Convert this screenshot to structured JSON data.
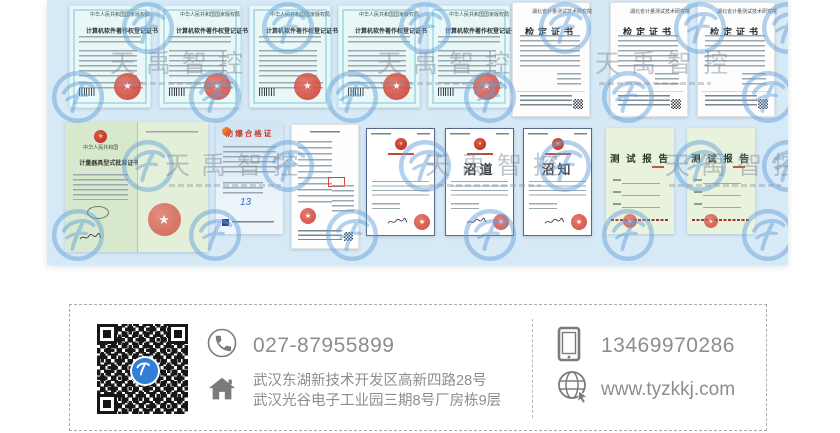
{
  "watermark": {
    "brand": "天禹智控"
  },
  "certificates": {
    "copyright": {
      "header": "中华人民共和国国家版权局",
      "title": "计算机软件著作权登记证书"
    },
    "verification": {
      "header": "湖北省计量测试技术研究院",
      "title": "检定证书"
    },
    "pattern_approval": {
      "country": "中华人民共和国",
      "title": "计量器具型式批准证书"
    },
    "explosion_proof": {
      "title": "防爆合格证"
    },
    "notices": [
      {
        "big_text": ""
      },
      {
        "big_text": "沼道"
      },
      {
        "big_text": "沼知"
      }
    ],
    "test_report": {
      "title": "测 试 报 告"
    }
  },
  "footer": {
    "phone": "027-87955899",
    "mobile": "13469970286",
    "address_line1": "武汉东湖新技术开发区高新四路28号",
    "address_line2": "武汉光谷电子工业园三期8号厂房栋9层",
    "website": "www.tyzkkj.com"
  }
}
